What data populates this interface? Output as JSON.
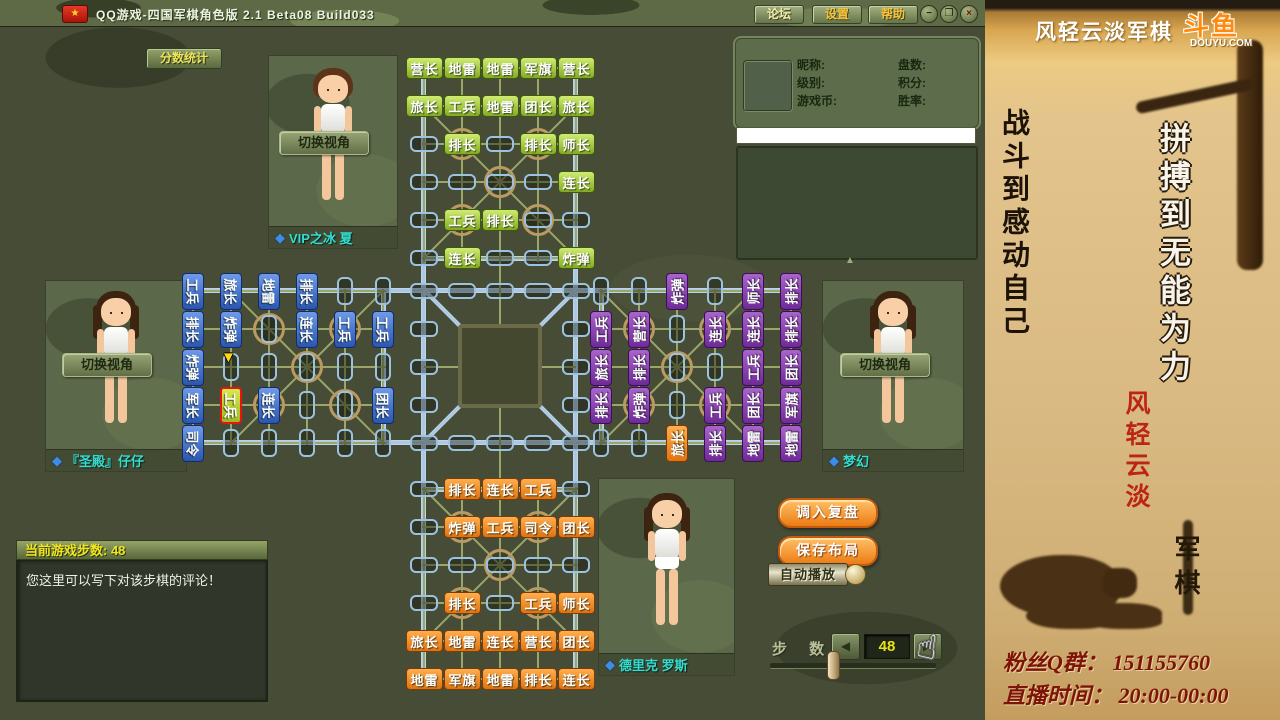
{
  "title_bar": {
    "title": "QQ游戏-四国军棋角色版 2.1 Beta08 Build033",
    "logo": "★",
    "buttons": [
      "论坛",
      "设置",
      "帮助"
    ],
    "minimize": "−",
    "restore": "❐",
    "close": "×"
  },
  "score_stats_button": "分数统计",
  "icons": {
    "gem": "◆",
    "prev": "◀",
    "next": "▶",
    "scroll_up": "▲",
    "cursor": "▼",
    "hand": "☝"
  },
  "players": {
    "top": {
      "switch_label": "切换视角",
      "name": "VIP之冰 夏"
    },
    "left": {
      "switch_label": "切换视角",
      "name": "『圣殿』仔仔"
    },
    "right": {
      "switch_label": "切换视角",
      "name": "梦幻"
    },
    "bottom": {
      "name": "德里克 罗斯"
    }
  },
  "info_panel": {
    "left_labels": [
      "昵称:",
      "级别:",
      "游戏币:"
    ],
    "right_labels": [
      "盘数:",
      "积分:",
      "胜率:"
    ]
  },
  "chart_data": {
    "type": "table",
    "title": "四国军棋棋盘布局 (step 48)",
    "board": {
      "top_color": "green",
      "bottom_color": "orange",
      "left_color": "blue",
      "right_color": "purple",
      "top": [
        [
          0,
          0,
          "营长"
        ],
        [
          1,
          0,
          "地雷"
        ],
        [
          2,
          0,
          "地雷"
        ],
        [
          3,
          0,
          "军旗"
        ],
        [
          4,
          0,
          "营长"
        ],
        [
          0,
          1,
          "旅长"
        ],
        [
          1,
          1,
          "工兵"
        ],
        [
          2,
          1,
          "地雷"
        ],
        [
          3,
          1,
          "团长"
        ],
        [
          4,
          1,
          "旅长"
        ],
        [
          1,
          2,
          "排长"
        ],
        [
          3,
          2,
          "排长"
        ],
        [
          4,
          2,
          "师长"
        ],
        [
          4,
          3,
          "连长"
        ],
        [
          1,
          4,
          "工兵"
        ],
        [
          2,
          4,
          "排长"
        ],
        [
          1,
          5,
          "连长"
        ],
        [
          4,
          5,
          "炸弹"
        ]
      ],
      "bottom": [
        [
          1,
          0,
          "排长"
        ],
        [
          2,
          0,
          "连长"
        ],
        [
          3,
          0,
          "工兵"
        ],
        [
          1,
          1,
          "炸弹"
        ],
        [
          2,
          1,
          "工兵"
        ],
        [
          3,
          1,
          "司令"
        ],
        [
          4,
          1,
          "团长"
        ],
        [
          1,
          3,
          "排长"
        ],
        [
          3,
          3,
          "工兵"
        ],
        [
          4,
          3,
          "师长"
        ],
        [
          0,
          4,
          "旅长"
        ],
        [
          1,
          4,
          "地雷"
        ],
        [
          2,
          4,
          "连长"
        ],
        [
          3,
          4,
          "营长"
        ],
        [
          4,
          4,
          "团长"
        ],
        [
          0,
          5,
          "地雷"
        ],
        [
          1,
          5,
          "军旗"
        ],
        [
          2,
          5,
          "地雷"
        ],
        [
          3,
          5,
          "排长"
        ],
        [
          4,
          5,
          "连长"
        ]
      ],
      "left": [
        [
          0,
          0,
          "工兵"
        ],
        [
          0,
          1,
          "排长"
        ],
        [
          0,
          2,
          "炸弹"
        ],
        [
          0,
          3,
          "军长"
        ],
        [
          0,
          4,
          "司令"
        ],
        [
          1,
          0,
          "旅长"
        ],
        [
          1,
          1,
          "炸弹"
        ],
        [
          1,
          3,
          "工兵",
          "sel"
        ],
        [
          2,
          0,
          "地雷"
        ],
        [
          2,
          3,
          "连长"
        ],
        [
          3,
          0,
          "排长"
        ],
        [
          3,
          1,
          "连长"
        ],
        [
          4,
          1,
          "工兵"
        ],
        [
          5,
          1,
          "工兵"
        ],
        [
          5,
          3,
          "团长"
        ]
      ],
      "right": [
        [
          0,
          1,
          "工兵"
        ],
        [
          0,
          2,
          "旅长"
        ],
        [
          0,
          3,
          "排长"
        ],
        [
          1,
          1,
          "营长"
        ],
        [
          1,
          2,
          "排长"
        ],
        [
          1,
          3,
          "炸弹"
        ],
        [
          2,
          0,
          "炸弹"
        ],
        [
          2,
          4,
          "旅长",
          "orange"
        ],
        [
          3,
          1,
          "连长"
        ],
        [
          3,
          3,
          "工兵"
        ],
        [
          3,
          4,
          "排长"
        ],
        [
          4,
          0,
          "师长"
        ],
        [
          4,
          1,
          "连长"
        ],
        [
          4,
          2,
          "工兵"
        ],
        [
          4,
          3,
          "团长"
        ],
        [
          4,
          4,
          "地雷"
        ],
        [
          5,
          0,
          "排长"
        ],
        [
          5,
          1,
          "排长"
        ],
        [
          5,
          2,
          "团长"
        ],
        [
          5,
          3,
          "军旗"
        ],
        [
          5,
          4,
          "地雷"
        ]
      ]
    }
  },
  "replay_controls": {
    "load": "调入复盘",
    "save": "保存布局",
    "autoplay": "自动播放",
    "steps_label": "步 数",
    "steps_value": "48"
  },
  "comment_panel": {
    "header": "当前游戏步数: 48",
    "body": "您这里可以写下对该步棋的评论！"
  },
  "stream_overlay": {
    "channel": "风轻云淡军棋",
    "logo": "斗鱼",
    "logo_domain": "DOUYU.COM",
    "slogan_black": "战斗到感动自己",
    "slogan_white": "拼搏到无能为力",
    "streamer": "风轻云淡",
    "game": "军棋",
    "fans": "粉丝Q群： 151155760",
    "time": "直播时间： 20:00-00:00"
  }
}
